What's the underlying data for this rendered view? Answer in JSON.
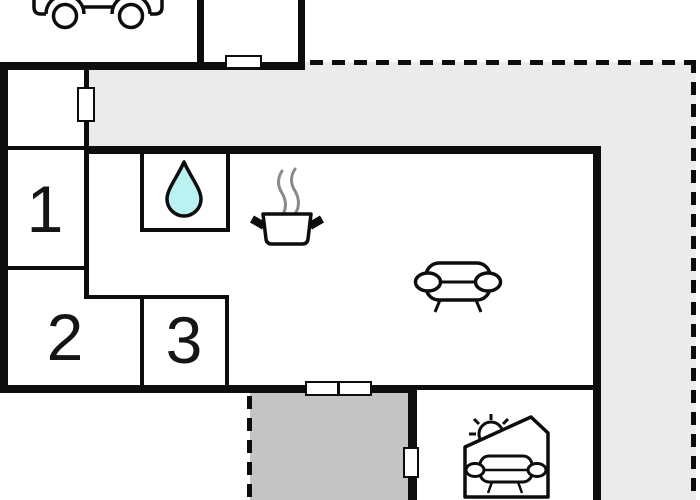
{
  "floorplan": {
    "room_labels": [
      "1",
      "2",
      "3"
    ],
    "icons": {
      "carport": "car-icon",
      "bathroom": "water-drop-icon",
      "kitchen": "cooking-pot-icon",
      "living_room": "sofa-icon",
      "sunroom": "house-with-sun-and-sofa-icon"
    },
    "areas": {
      "terrace_upper": "light-gray-terrace",
      "terrace_lower": "dark-gray-covered-terrace",
      "boundary": "dashed-property-line"
    },
    "colors": {
      "wall": "#0d0d0d",
      "terrace_light": "#ebebeb",
      "terrace_dark": "#c4c4c4",
      "water_drop": "#b9f2f0",
      "steam": "#8a8a8a",
      "background": "#ffffff"
    }
  }
}
